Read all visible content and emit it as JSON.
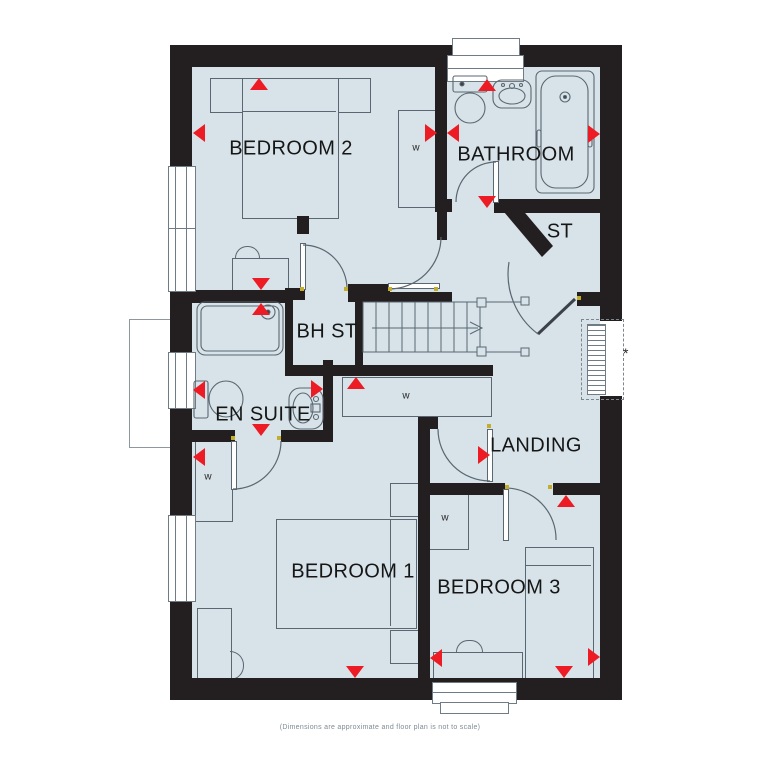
{
  "plan": {
    "title": "First floor plan",
    "rooms": {
      "bedroom2": "BEDROOM 2",
      "bathroom": "BATHROOM",
      "storage": "ST",
      "bulkhead_storage": "BH ST",
      "en_suite": "EN SUITE",
      "landing": "LANDING",
      "bedroom1": "BEDROOM 1",
      "bedroom3": "BEDROOM 3"
    },
    "wardrobe_label": "w",
    "optional_window_marker": "*",
    "caption": "(Dimensions are approximate and floor plan is not to scale)",
    "colors": {
      "floor_fill": "#d7e3e9",
      "wall": "#231f20",
      "marker_red": "#ed1c24",
      "fixture_outline": "#5b6770"
    }
  }
}
